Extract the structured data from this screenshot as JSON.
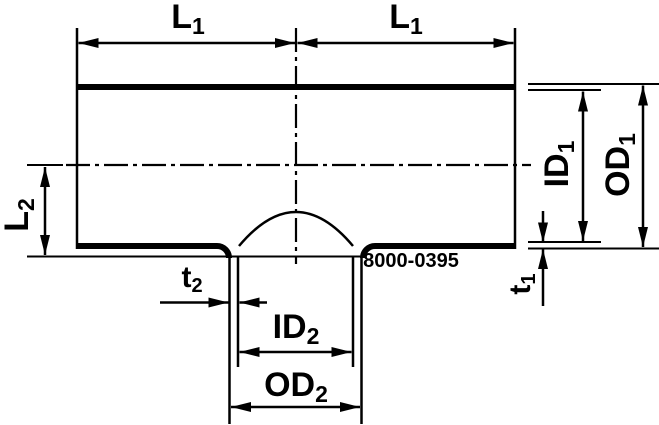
{
  "drawing": {
    "background_color": "#ffffff",
    "line_color": "#000000",
    "part_number": "8000-0395",
    "labels": {
      "l1_left": {
        "base": "L",
        "sub": "1"
      },
      "l1_right": {
        "base": "L",
        "sub": "1"
      },
      "l2": {
        "base": "L",
        "sub": "2"
      },
      "id1": {
        "base": "ID",
        "sub": "1"
      },
      "od1": {
        "base": "OD",
        "sub": "1"
      },
      "t1": {
        "base": "t",
        "sub": "1"
      },
      "t2": {
        "base": "t",
        "sub": "2"
      },
      "id2": {
        "base": "ID",
        "sub": "2"
      },
      "od2": {
        "base": "OD",
        "sub": "2"
      }
    }
  }
}
